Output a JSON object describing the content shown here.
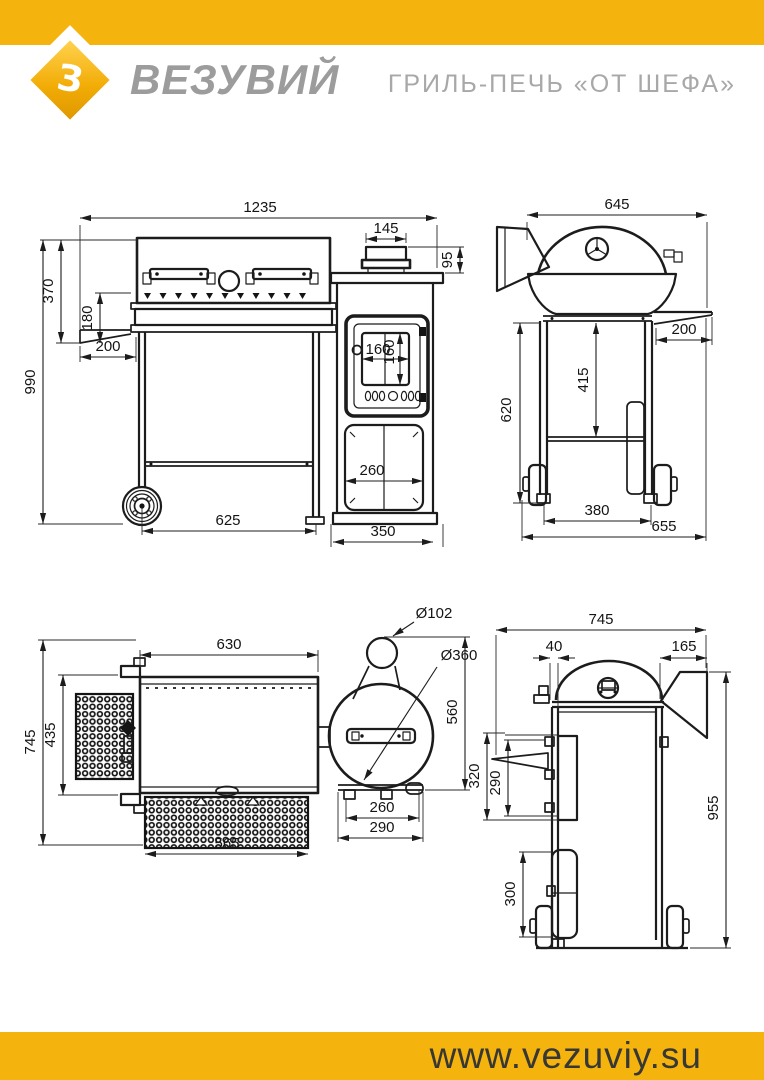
{
  "brand": {
    "name": "ВЕЗУВИЙ",
    "logo_letter": "З"
  },
  "header": {
    "title": "ГРИЛЬ-ПЕЧЬ «ОТ ШЕФА»"
  },
  "footer": {
    "website": "www.vezuviy.su"
  },
  "colors": {
    "accent_yellow": "#f5b30e",
    "line_color": "#1c1c1c",
    "brand_gray": "#9c9c9c",
    "title_gray": "#a8a8a8",
    "footer_text": "#373735"
  },
  "drawing": {
    "front": {
      "overall_width": "1235",
      "chimney_width": "145",
      "chimney_height": "95",
      "body_height": "370",
      "grate_height": "180",
      "shelf_depth": "200",
      "overall_height": "990",
      "glass_width": "160",
      "glass_height": "160",
      "drawer_width": "260",
      "wheelbase": "625",
      "firebox_width": "350"
    },
    "side": {
      "overall_width": "645",
      "shelf_depth": "200",
      "shelf_height": "415",
      "frame_height": "620",
      "wheel_track": "380",
      "overall_depth": "655"
    },
    "top": {
      "body_width": "630",
      "chimney_diameter": "Ø102",
      "barrel_diameter": "Ø360",
      "overall_depth": "745",
      "shelf_width": "435",
      "barrel_depth": "560",
      "base_inner": "260",
      "base_outer": "290",
      "tray_width": "565"
    },
    "side2": {
      "overall_width": "745",
      "offset": "40",
      "chimney_width": "165",
      "shelf_top_height": "320",
      "shelf_height": "290",
      "drawer_height": "300",
      "overall_height": "955"
    }
  }
}
